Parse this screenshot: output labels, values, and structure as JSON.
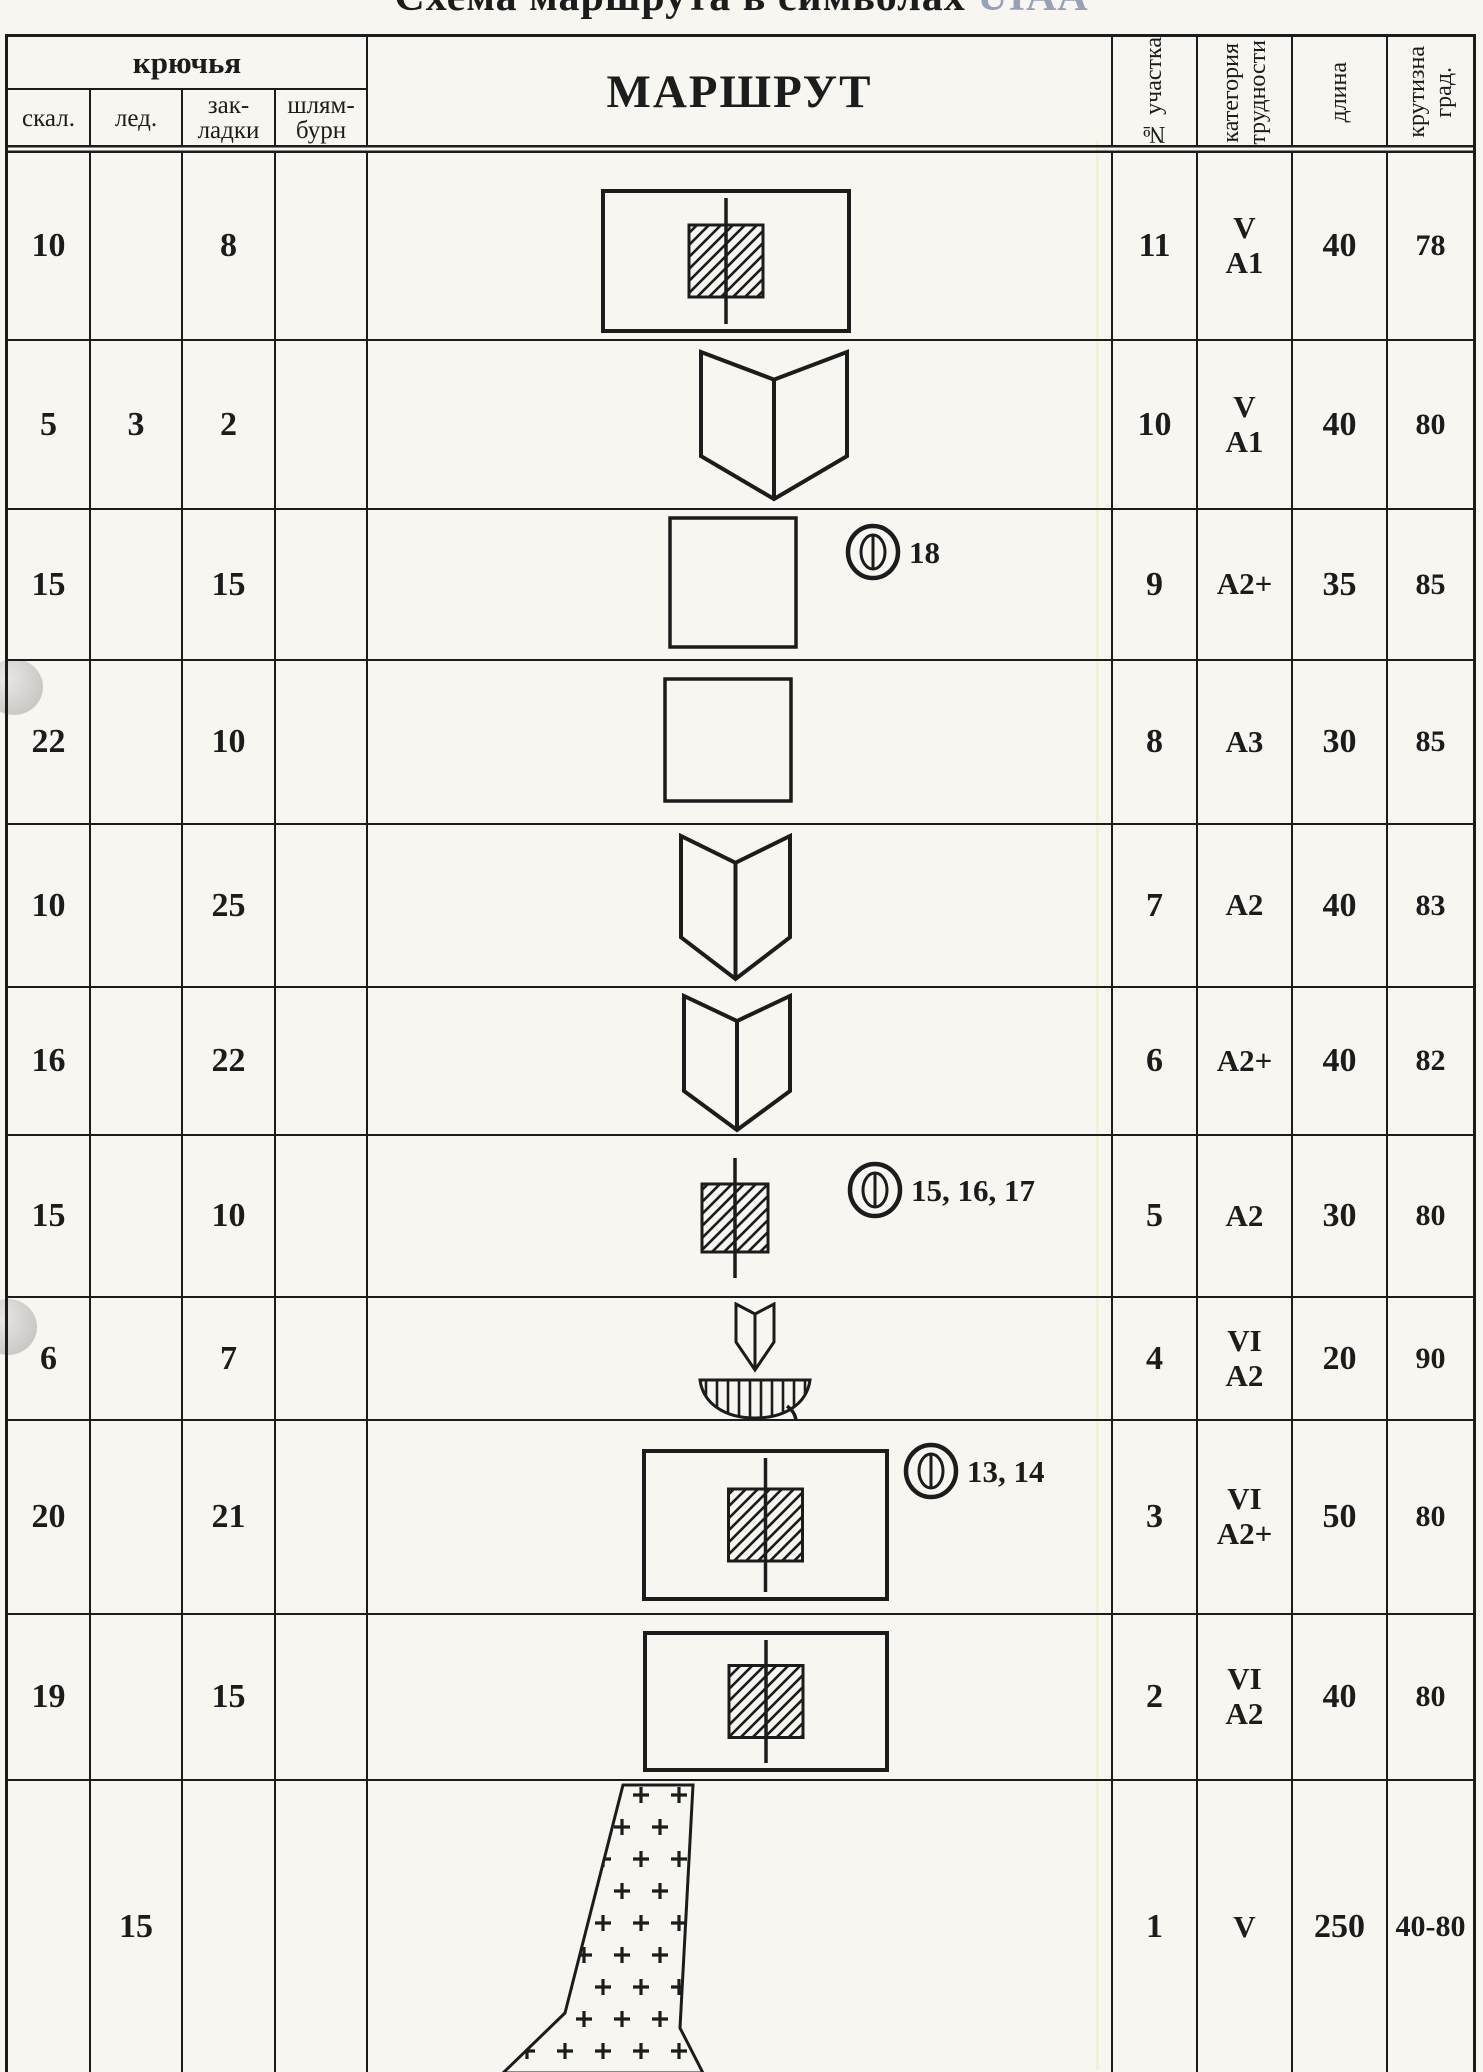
{
  "title": {
    "main": "Схема маршрута в символах",
    "suffix": "UIAA"
  },
  "header": {
    "pitons_group": "крючья",
    "sub_columns": [
      "скал.",
      "лед.",
      "зак-\nладки",
      "шлям-\nбурн"
    ],
    "route": "МАРШРУТ",
    "section_no": "№ участка",
    "category": "категория\nтрудности",
    "length": "длина",
    "steepness": "крутизна\nград."
  },
  "rows": [
    {
      "skal": "10",
      "led": "",
      "zakladki": "8",
      "shlyamburn": "",
      "symbol": "rect-plug",
      "station": "",
      "section": "11",
      "category": "V\nA1",
      "length": "40",
      "steepness": "78"
    },
    {
      "skal": "5",
      "led": "3",
      "zakladki": "2",
      "shlyamburn": "",
      "symbol": "inner-corner",
      "station": "",
      "section": "10",
      "category": "V\nA1",
      "length": "40",
      "steepness": "80"
    },
    {
      "skal": "15",
      "led": "",
      "zakladki": "15",
      "shlyamburn": "",
      "symbol": "square",
      "station": "18",
      "section": "9",
      "category": "A2+",
      "length": "35",
      "steepness": "85"
    },
    {
      "skal": "22",
      "led": "",
      "zakladki": "10",
      "shlyamburn": "",
      "symbol": "square",
      "station": "",
      "section": "8",
      "category": "A3",
      "length": "30",
      "steepness": "85"
    },
    {
      "skal": "10",
      "led": "",
      "zakladki": "25",
      "shlyamburn": "",
      "symbol": "inner-corner",
      "station": "",
      "section": "7",
      "category": "A2",
      "length": "40",
      "steepness": "83"
    },
    {
      "skal": "16",
      "led": "",
      "zakladki": "22",
      "shlyamburn": "",
      "symbol": "inner-corner",
      "station": "",
      "section": "6",
      "category": "A2+",
      "length": "40",
      "steepness": "82"
    },
    {
      "skal": "15",
      "led": "",
      "zakladki": "10",
      "shlyamburn": "",
      "symbol": "plug",
      "station": "15, 16, 17",
      "section": "5",
      "category": "A2",
      "length": "30",
      "steepness": "80"
    },
    {
      "skal": "6",
      "led": "",
      "zakladki": "7",
      "shlyamburn": "",
      "symbol": "corner-overhang",
      "station": "",
      "section": "4",
      "category": "VI\nA2",
      "length": "20",
      "steepness": "90"
    },
    {
      "skal": "20",
      "led": "",
      "zakladki": "21",
      "shlyamburn": "",
      "symbol": "rect-plug",
      "station": "13, 14",
      "section": "3",
      "category": "VI\nA2+",
      "length": "50",
      "steepness": "80"
    },
    {
      "skal": "19",
      "led": "",
      "zakladki": "15",
      "shlyamburn": "",
      "symbol": "rect-plug",
      "station": "",
      "section": "2",
      "category": "VI\nA2",
      "length": "40",
      "steepness": "80"
    },
    {
      "skal": "",
      "led": "15",
      "zakladki": "",
      "shlyamburn": "",
      "symbol": "snow-couloir",
      "station": "",
      "section": "1",
      "category": "V",
      "length": "250",
      "steepness": "40-80"
    }
  ]
}
